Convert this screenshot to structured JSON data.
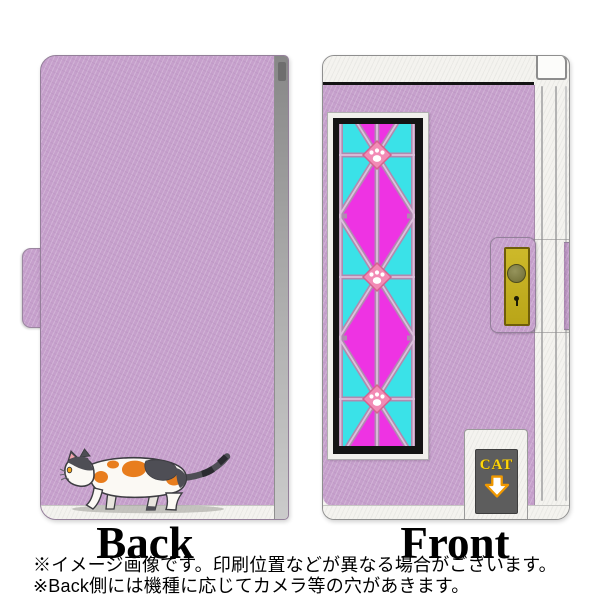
{
  "product": {
    "back_label": "Back",
    "front_label": "Front",
    "cat_door_label": "CAT",
    "notes": [
      "※イメージ画像です。印刷位置などが異なる場合がございます。",
      "※Back側には機種に応じてカメラ等の穴があきます。"
    ]
  },
  "icons": {
    "cat_door_arrow": "arrow-down",
    "glass_paw": "paw-print",
    "back_illustration": "calico-cat"
  },
  "colors": {
    "case_lavender": "#c6a0cc",
    "glass_magenta": "#ee33e3",
    "glass_cyan": "#3ae2e8",
    "glass_lattice": "#b08ab0",
    "paw_diamond_pink": "#f28bb5",
    "clasp_yellow": "#c3af1e",
    "door_gray": "#5d5d5d",
    "door_label_yellow": "#ffd60a",
    "cat_orange": "#e87d1d",
    "cat_dark_gray": "#4e4e55",
    "frame_black": "#141414",
    "edge_white": "#f4f3ef"
  }
}
